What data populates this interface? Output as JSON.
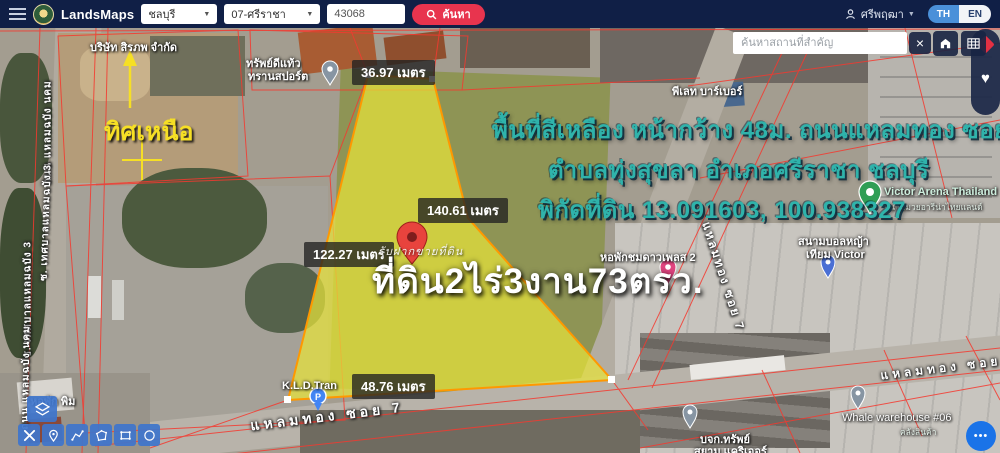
{
  "navbar": {
    "brand": "LandsMaps",
    "province": "ชลบุรี",
    "district": "07-ศรีราชา",
    "parcel_no": "43068",
    "search_label": "ค้นหา",
    "user_name": "ศรีพฤฒา",
    "lang_th": "TH",
    "lang_en": "EN"
  },
  "icons": {
    "chevron": "▼",
    "clear": "×",
    "heart": "♥",
    "dots": "•••"
  },
  "map": {
    "poi_search": {
      "placeholder": "ค้นหาสถานที่สำคัญ"
    },
    "measurements": {
      "top": "36.97 เมตร",
      "right": "140.61 เมตร",
      "left": "122.27 เมตร",
      "bottom": "48.76 เมตร"
    },
    "annotation": {
      "line1": "พื้นที่สีเหลือง หน้ากว้าง 48ม. ถนนแหลมทอง ซอย7",
      "line2": "ตำบลทุ่งสุขลา อำเภอศรีราชา ชลบุรี",
      "line3": "พิกัดที่ดิน 13.091603, 100.938327",
      "north_label": "ทิศเหนือ",
      "area_text": "ที่ดิน2ไร่3งาน73ตรว.",
      "watermark": "รับฝากขายที่ดิน"
    },
    "place_labels": [
      {
        "name": "บริษัท สิรภพ จำกัด"
      },
      {
        "line1": "ทรัพย์ดีแท้ว",
        "line2": "ทรานสปอร์ต"
      },
      {
        "name": "พีเลท บาร์เบอร์"
      },
      {
        "name": "Victor Arena Thailand",
        "sub": "สนามมวยอารีน่าไทยแลนด์"
      },
      {
        "name": "หอพักชมดาวเพลส 2"
      },
      {
        "line1": "สนามบอลหญ้า",
        "line2": "เทียม Victor"
      },
      {
        "name": "K.L.D.Tran",
        "pin_letter": "P"
      },
      {
        "name": "หอพัก พิม"
      },
      {
        "name": "Whale warehouse #06",
        "sub": "คลังสินค้า"
      },
      {
        "line1": "บจก.ทรัพย์",
        "line2": "สยาม แคริเออร์"
      }
    ],
    "street_labels": {
      "laem_thong_bottom": "แหลมทอง ซอย 7",
      "laem_thong_diag": "แหลมทอง ซอย 7",
      "laem_thong_right": "แหลมทอง ซอย 7",
      "left_road_a": "ถนน แหลมฉบัง นคม",
      "left_road_b": "ซ. เทศบาลแหลมฉบัง 3",
      "left_road_c": "ซ. เทศบาลแหลมฉบัง 3",
      "left_road_d": "ถนน แหลมฉบัง นคม"
    }
  },
  "colors": {
    "navbar_bg": "#101f46",
    "accent_red": "#e8344e",
    "lang_active_blue": "#4a90d9",
    "teal_text": "#2fb3ab",
    "north_yellow": "#f6df25",
    "parcel_fill": "#e8e33a",
    "parcel_stroke": "#ff9800",
    "cadastral_red": "#f5392f",
    "tool_blue": "#3e75cb",
    "control_dark": "#182442",
    "more_blue": "#1a73e8"
  }
}
